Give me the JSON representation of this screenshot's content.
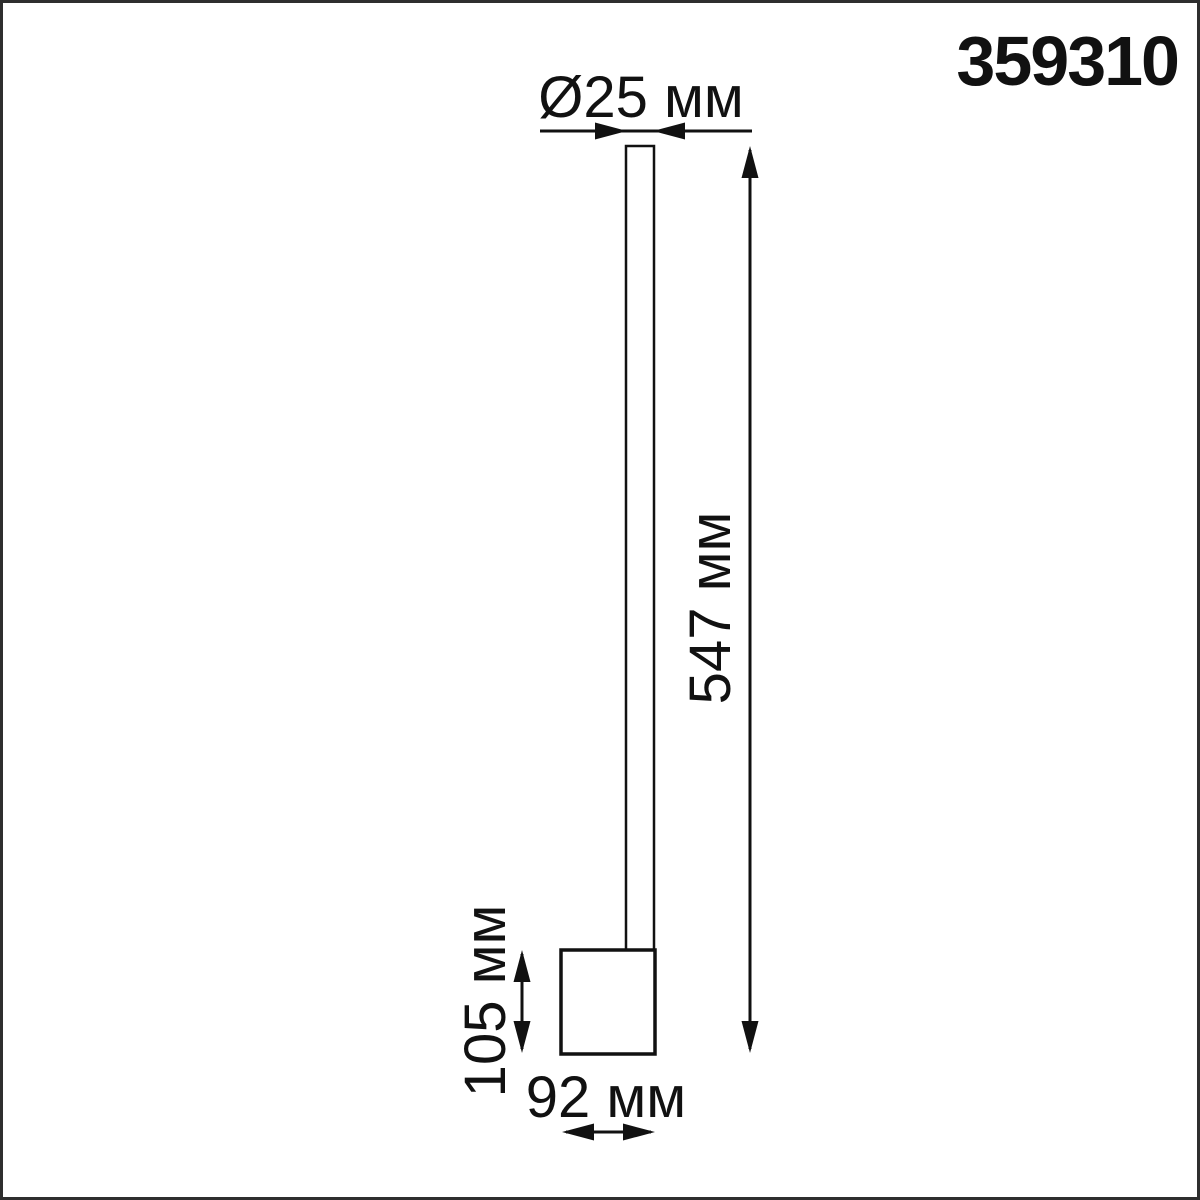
{
  "product_code": "359310",
  "unit": "мм",
  "labels": {
    "diameter": "Ø25 мм",
    "height": "547 мм",
    "base_height": "105 мм",
    "base_width": "92 мм"
  },
  "dimensions": {
    "tube_diameter_mm": 25,
    "tube_height_mm": 547,
    "base_height_mm": 105,
    "base_width_mm": 92
  },
  "colors": {
    "line": "#111111",
    "text": "#111111",
    "background": "#ffffff",
    "border": "#2e2e2e"
  }
}
